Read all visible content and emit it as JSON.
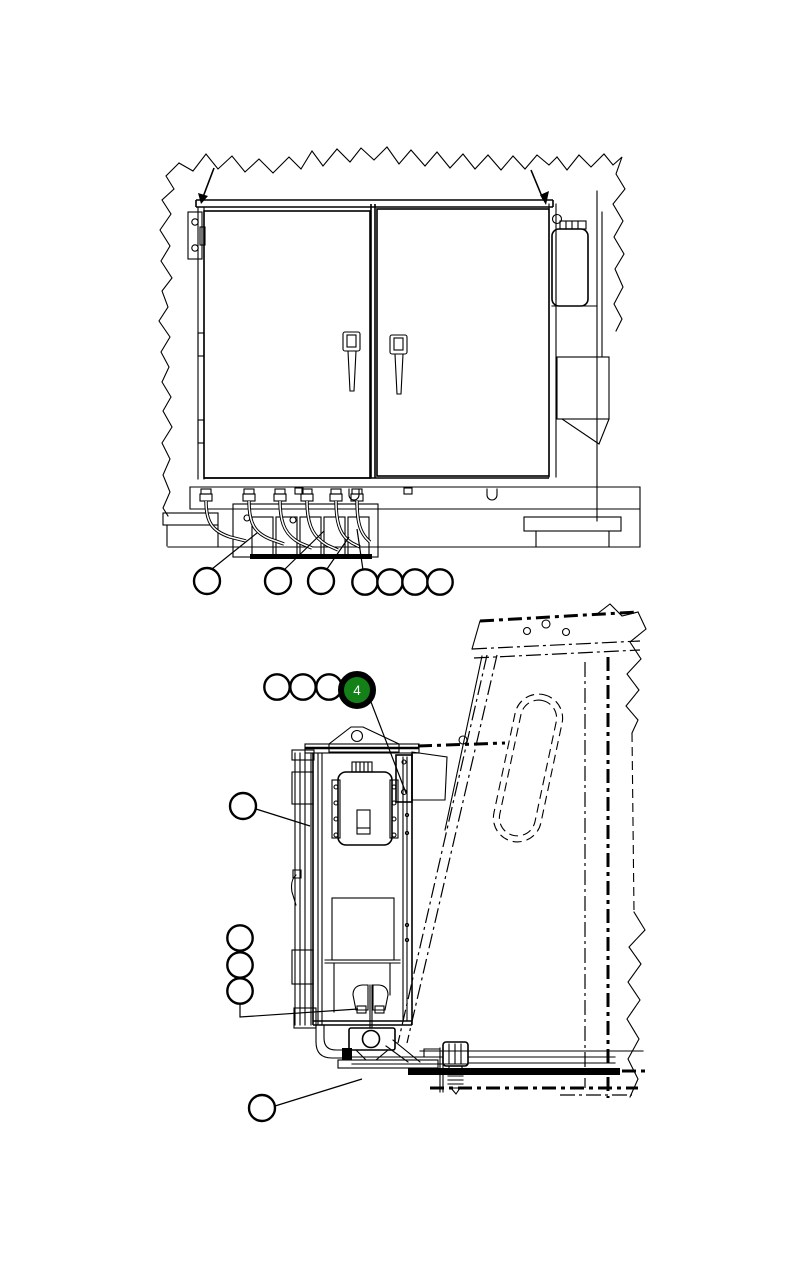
{
  "canvas": {
    "background": "#ffffff",
    "line_color": "#000000",
    "width_px": 786,
    "height_px": 1271
  },
  "figure_top": {
    "callouts": [
      {
        "label": "",
        "highlighted": false
      },
      {
        "label": "",
        "highlighted": false
      },
      {
        "label": "",
        "highlighted": false
      },
      {
        "label": "",
        "highlighted": false
      },
      {
        "label": "",
        "highlighted": false
      },
      {
        "label": "",
        "highlighted": false
      },
      {
        "label": "",
        "highlighted": false
      }
    ]
  },
  "figure_bottom": {
    "callout_chain": [
      {
        "label": "",
        "highlighted": false
      },
      {
        "label": "",
        "highlighted": false
      },
      {
        "label": "",
        "highlighted": false
      },
      {
        "label": "4",
        "highlighted": true
      }
    ],
    "callout_single_left": {
      "label": "",
      "highlighted": false
    },
    "callout_left_chain": [
      {
        "label": "",
        "highlighted": false
      },
      {
        "label": "",
        "highlighted": false
      },
      {
        "label": "",
        "highlighted": false
      }
    ],
    "callout_bottom": {
      "label": "",
      "highlighted": false
    },
    "highlight": {
      "fill": "#148018",
      "ring": "#000000",
      "text_color": "#ffffff"
    }
  }
}
